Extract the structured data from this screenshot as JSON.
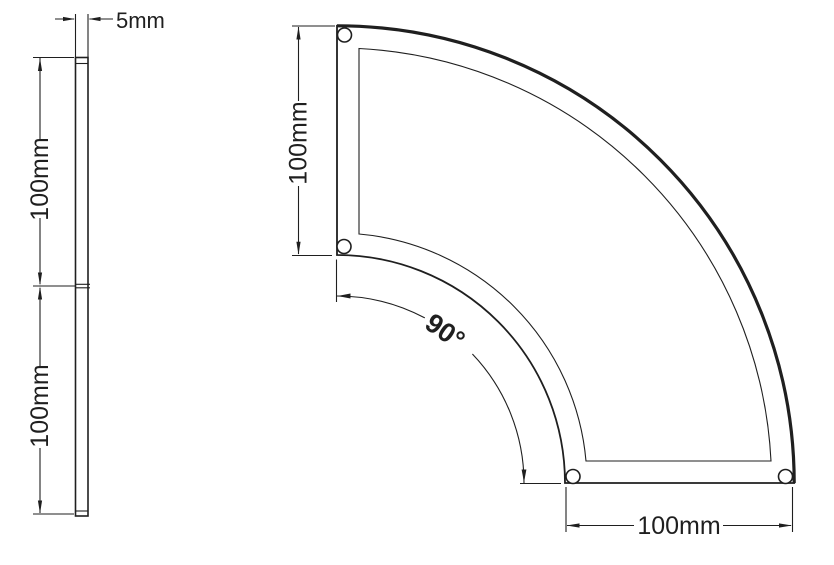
{
  "page": {
    "background": "#ffffff",
    "line_color": "#1f1f1f"
  },
  "side_view": {
    "thickness_label": "5mm",
    "upper_length_label": "100mm",
    "lower_length_label": "100mm"
  },
  "arc_view": {
    "radial_width_label": "100mm",
    "bottom_width_label": "100mm",
    "angle_label": "90°"
  }
}
